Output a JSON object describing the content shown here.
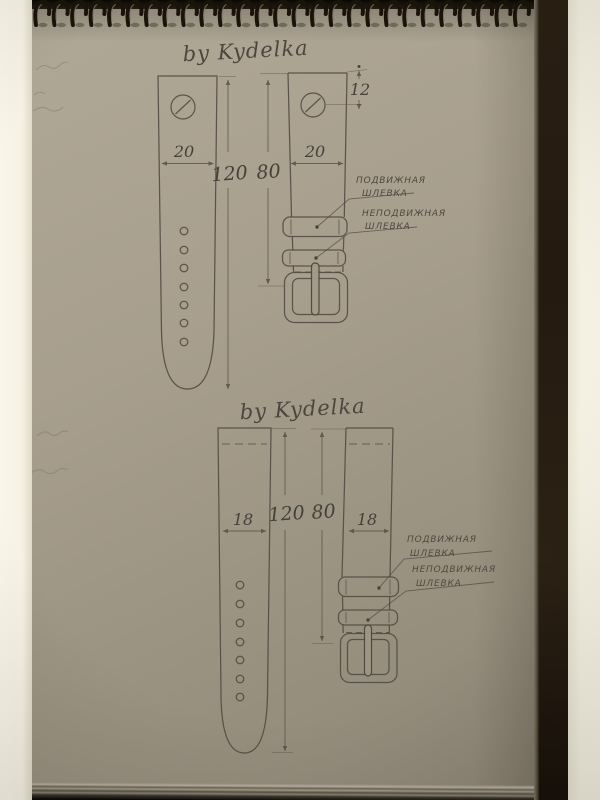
{
  "binding": {
    "loop_count": 27
  },
  "drawings": [
    {
      "title": "by Kydelka",
      "width_left": "20",
      "width_right": "20",
      "total_length": "120",
      "buckle_side_length": "80",
      "bar_offset": "12",
      "movable_keeper_line1": "ПОДВИЖНАЯ",
      "movable_keeper_line2": "ШЛЕВКА",
      "fixed_keeper_line1": "НЕПОДВИЖНАЯ",
      "fixed_keeper_line2": "ШЛЕВКА"
    },
    {
      "title": "by Kydelka",
      "width_left": "18",
      "width_right": "18",
      "total_length": "120",
      "buckle_side_length": "80",
      "movable_keeper_line1": "ПОДВИЖНАЯ",
      "movable_keeper_line2": "ШЛЕВКА",
      "fixed_keeper_line1": "НЕПОДВИЖНАЯ",
      "fixed_keeper_line2": "ШЛЕВКА"
    }
  ]
}
